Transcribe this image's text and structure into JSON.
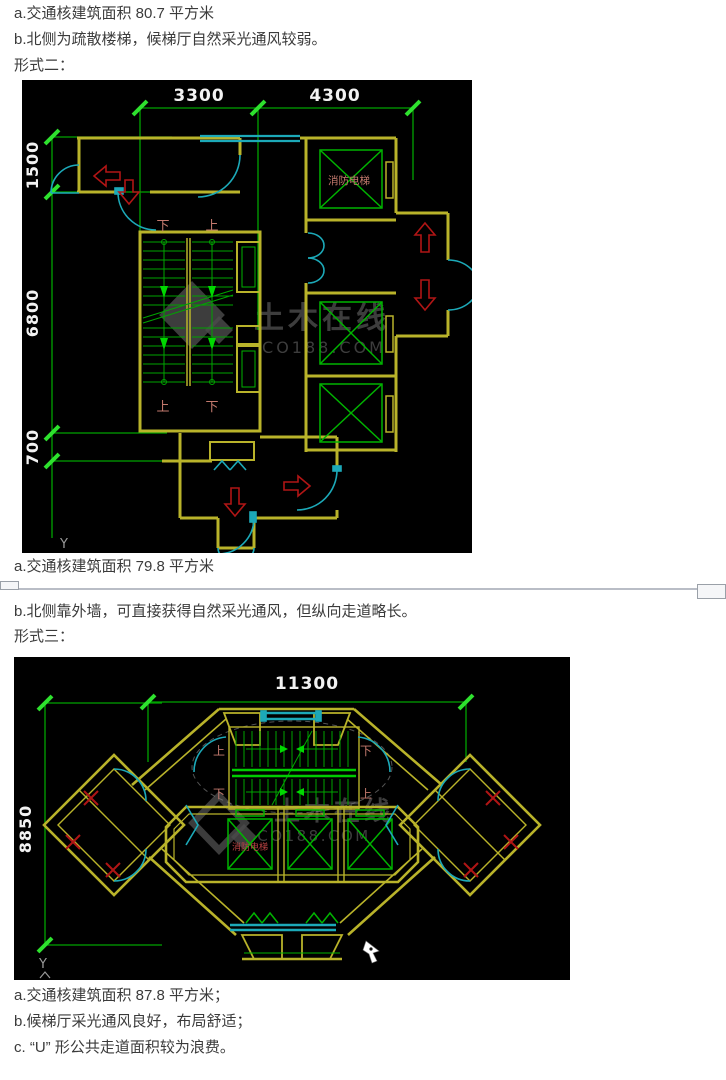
{
  "colors": {
    "page_bg": "#ffffff",
    "body_text": "#3b3b3b",
    "canvas_bg": "#000000",
    "wall_yellow": "#b9b32a",
    "door_cyan": "#1ca9b8",
    "dim_green": "#00a400",
    "tick_green": "#2ee22e",
    "elevator_green": "#00b400",
    "arrow_red": "#b01515",
    "cad_label_red": "#c47a6e",
    "dim_text_white": "#f2f2f2",
    "watermark_gray": "#4b4b4b",
    "divider_gray": "#b9bdc6"
  },
  "texts": {
    "note1a": "a.交通核建筑面积 80.7 平方米",
    "note1b": "b.北侧为疏散楼梯，候梯厅自然采光通风较弱。",
    "form2_heading": "形式二：",
    "note2a": "a.交通核建筑面积 79.8 平方米",
    "note2b": "b.北侧靠外墙，可直接获得自然采光通风，但纵向走道略长。",
    "form3_heading": "形式三：",
    "note3a": "a.交通核建筑面积 87.8 平方米；",
    "note3b": "b.候梯厅采光通风良好，布局舒适；",
    "note3c": "c. “U” 形公共走道面积较为浪费。"
  },
  "drawing1": {
    "dim_top_left": "3300",
    "dim_top_right": "4300",
    "dim_left_top": "1500",
    "dim_left_mid": "6800",
    "dim_left_bottom": "700",
    "fire_elevator_label": "消防电梯",
    "stair_top_left": "下",
    "stair_top_right": "上",
    "stair_bottom_left": "上",
    "stair_bottom_right": "下",
    "axis_label": "Y",
    "watermark_name": "土木在线",
    "watermark_site": "CO188.COM"
  },
  "drawing2": {
    "dim_width": "11300",
    "dim_height": "8850",
    "fire_elevator_label": "消防电梯",
    "stair_top_left": "上",
    "stair_top_right": "下",
    "stair_bottom_left": "下",
    "stair_bottom_right": "上",
    "axis_label": "Y",
    "watermark_name": "土木在线",
    "watermark_site": "CO188.COM"
  }
}
